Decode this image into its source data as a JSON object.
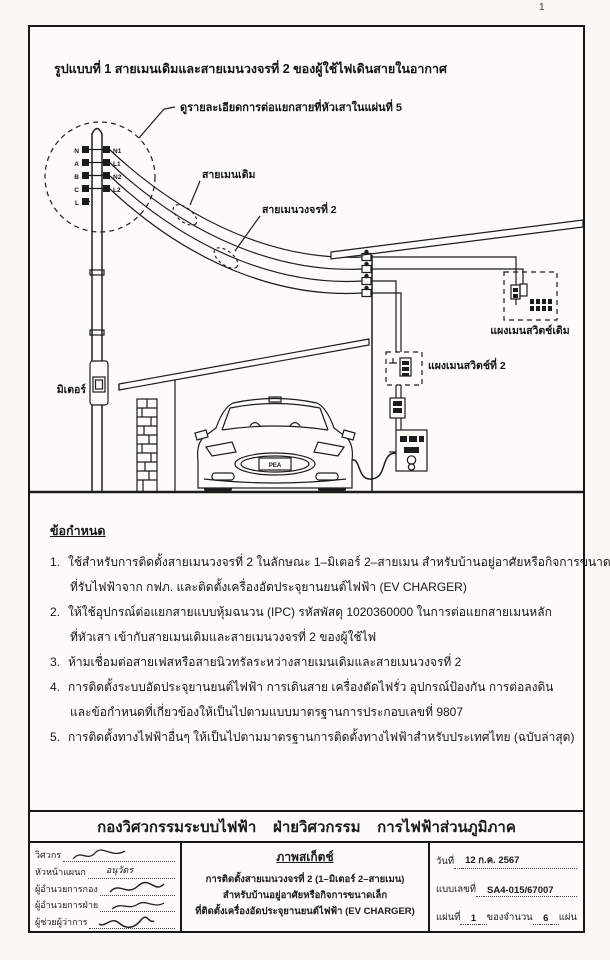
{
  "page": {
    "corner_page_number": "1"
  },
  "diagram": {
    "title": "รูปแบบที่ 1  สายเมนเดิมและสายเมนวงจรที่ 2  ของผู้ใช้ไฟเดินสายในอากาศ",
    "callout_note": "ดูรายละเอียดการต่อแยกสายที่หัวเสาในแผ่นที่ 5",
    "pole_terminals_left": [
      "N",
      "A",
      "B",
      "C",
      "L"
    ],
    "pole_terminals_right": [
      "N1",
      "L1",
      "N2",
      "L2"
    ],
    "labels": {
      "existing_main_line": "สายเมนเดิม",
      "circuit2_main_line": "สายเมนวงจรที่ 2",
      "existing_main_panel": "แผงเมนสวิตช์เดิม",
      "circuit2_main_panel": "แผงเมนสวิตช์ที่ 2",
      "meter": "มิเตอร์",
      "car_plate": "PEA"
    }
  },
  "requirements": {
    "heading": "ข้อกำหนด",
    "items": [
      {
        "no": "1.",
        "lines": [
          "ใช้สำหรับการติดตั้งสายเมนวงจรที่ 2 ในลักษณะ 1–มิเตอร์ 2–สายเมน สำหรับบ้านอยู่อาศัยหรือกิจการขนาดเล็ก",
          "ที่รับไฟฟ้าจาก กฟภ. และติดตั้งเครื่องอัดประจุยานยนต์ไฟฟ้า (EV CHARGER)"
        ]
      },
      {
        "no": "2.",
        "lines": [
          "ให้ใช้อุปกรณ์ต่อแยกสายแบบหุ้มฉนวน (IPC) รหัสพัสดุ 1020360000 ในการต่อแยกสายเมนหลัก",
          "ที่หัวเสา เข้ากับสายเมนเดิมและสายเมนวงจรที่ 2 ของผู้ใช้ไฟ"
        ]
      },
      {
        "no": "3.",
        "lines": [
          "ห้ามเชื่อมต่อสายเฟสหรือสายนิวทรัลระหว่างสายเมนเดิมและสายเมนวงจรที่ 2"
        ]
      },
      {
        "no": "4.",
        "lines": [
          "การติดตั้งระบบอัดประจุยานยนต์ไฟฟ้า การเดินสาย เครื่องตัดไฟรั่ว อุปกรณ์ป้องกัน การต่อลงดิน",
          "และข้อกำหนดที่เกี่ยวข้องให้เป็นไปตามแบบมาตรฐานการประกอบเลขที่ 9807"
        ]
      },
      {
        "no": "5.",
        "lines": [
          "การติดตั้งทางไฟฟ้าอื่นๆ ให้เป็นไปตามมาตรฐานการติดตั้งทางไฟฟ้าสำหรับประเทศไทย (ฉบับล่าสุด)"
        ]
      }
    ]
  },
  "footer": {
    "department_banner": "กองวิศวกรรมระบบไฟฟ้า    ฝ่ายวิศวกรรม    การไฟฟ้าส่วนภูมิภาค"
  },
  "title_block": {
    "signatures": [
      {
        "label": "วิศวกร"
      },
      {
        "label": "หัวหน้าแผนก",
        "name": "อนุวัตร"
      },
      {
        "label": "ผู้อำนวยการกอง"
      },
      {
        "label": "ผู้อำนวยการฝ่าย"
      },
      {
        "label": "ผู้ช่วยผู้ว่าการ"
      }
    ],
    "center": {
      "heading": "ภาพสเก็ตช์",
      "line1": "การติดตั้งสายเมนวงจรที่ 2 (1–มิเตอร์ 2–สายเมน)",
      "line2": "สำหรับบ้านอยู่อาศัยหรือกิจการขนาดเล็ก",
      "line3": "ที่ติดตั้งเครื่องอัดประจุยานยนต์ไฟฟ้า (EV CHARGER)"
    },
    "right": {
      "date_label": "วันที่",
      "date_value": "12 ก.ค. 2567",
      "drawing_no_label": "แบบเลขที่",
      "drawing_no_value": "SA4-015/67007",
      "sheet_label": "แผ่นที่",
      "sheet_number": "1",
      "of_label": "ของจำนวน",
      "sheet_total": "6",
      "sheet_unit": "แผ่น"
    }
  }
}
